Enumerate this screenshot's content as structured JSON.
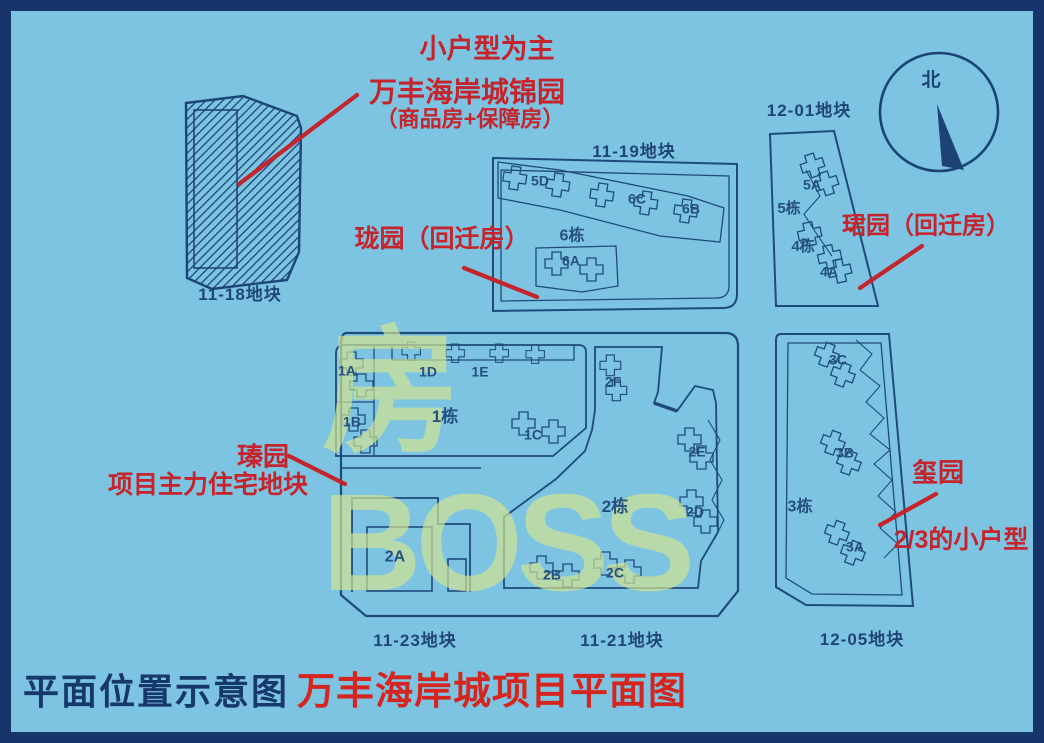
{
  "map": {
    "watermark": "房BOSS",
    "compass_north": "北",
    "caption": {
      "left": "平面位置示意图",
      "right": "万丰海岸城项目平面图"
    },
    "annotations": {
      "jin_line1": "小户型为主",
      "jin_line2": "万丰海岸城锦园",
      "jin_line3": "（商品房+保障房）",
      "long": "珑园（回迁房）",
      "jun": "珺园（回迁房）",
      "zhen_line1": "瑧园",
      "zhen_line2": "项目主力住宅地块",
      "xi_line1": "玺园",
      "xi_line2": "2/3的小户型"
    },
    "plot_labels": {
      "p1118": "11-18地块",
      "p1119": "11-19地块",
      "p1201": "12-01地块",
      "p1123": "11-23地块",
      "p1121": "11-21地块",
      "p1205": "12-05地块"
    },
    "buildings": {
      "b5d": "5D",
      "b6c": "6C",
      "b6b": "6B",
      "b6dong": "6栋",
      "b6a": "6A",
      "b5a": "5A",
      "b5dong": "5栋",
      "b4dong": "4栋",
      "b4a": "4A",
      "b1a": "1A",
      "b1d": "1D",
      "b1e": "1E",
      "b1b": "1B",
      "b1dong": "1栋",
      "b1c": "1C",
      "b2f": "2F",
      "b2e": "2E",
      "b2dong": "2栋",
      "b2d": "2D",
      "b2a": "2A",
      "b2b": "2B",
      "b2c": "2C",
      "b3c": "3C",
      "b3b": "3B",
      "b3dong": "3栋",
      "b3a": "3A"
    },
    "colors": {
      "background": "#7cc4e1",
      "frame": "#17356b",
      "line": "#1f4a7c",
      "annotation_red": "#c5242c",
      "title_red": "#d6251f",
      "watermark": "#d5e593"
    }
  }
}
